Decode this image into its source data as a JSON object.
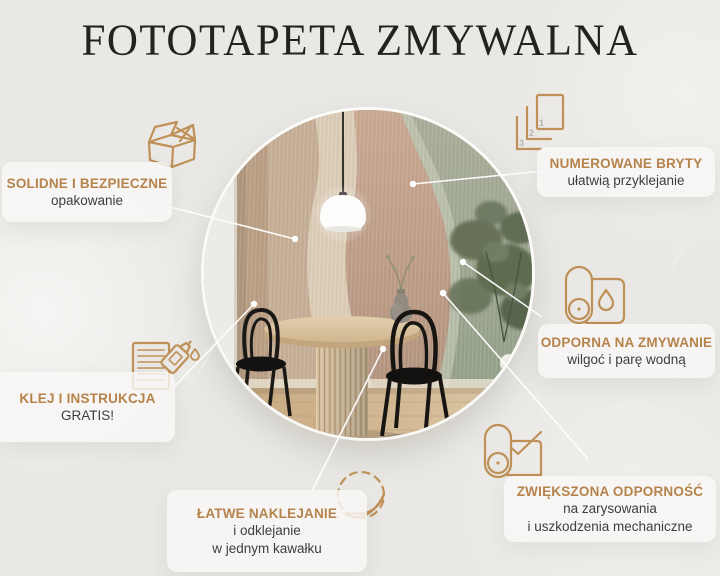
{
  "page": {
    "title": "FOTOTAPETA ZMYWALNA",
    "background_color": "#e9e8e4",
    "accent_color": "#b5834b",
    "text_color": "#3e3e40",
    "icon_stroke_color": "#bf9057",
    "callout_line_color": "#ffffff"
  },
  "features": [
    {
      "id": "packaging",
      "icon": "box-icon",
      "title": "SOLIDNE I BEZPIECZNE",
      "line1": "opakowanie"
    },
    {
      "id": "numbered-panels",
      "icon": "numbered-sheets-icon",
      "title": "NUMEROWANE BRYTY",
      "line1": "ułatwią przyklejanie",
      "sheet_numbers": [
        "1",
        "2",
        "3"
      ]
    },
    {
      "id": "washable",
      "icon": "roll-water-drop-icon",
      "title": "ODPORNA NA ZMYWANIE",
      "line1": "wilgoć i parę wodną"
    },
    {
      "id": "durability",
      "icon": "roll-checkmark-icon",
      "title": "ZWIĘKSZONA ODPORNOŚĆ",
      "line1": "na zarysowania",
      "line2": "i uszkodzenia mechaniczne"
    },
    {
      "id": "glue-gratis",
      "icon": "glue-and-instructions-icon",
      "title": "KLEJ I INSTRUKCJA",
      "line1": "GRATIS!"
    },
    {
      "id": "easy-apply",
      "icon": "peel-sticker-icon",
      "title": "ŁATWE NAKLEJANIE",
      "line1": "i odklejanie",
      "line2": "w jednym kawałku"
    }
  ]
}
